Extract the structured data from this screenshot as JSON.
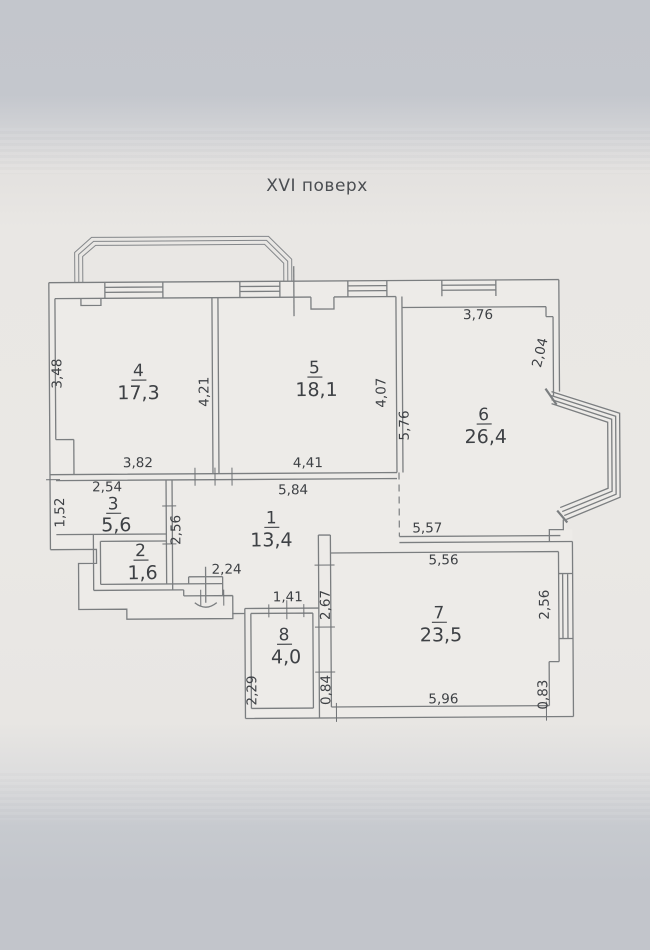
{
  "title": "XVI поверх",
  "rooms": [
    {
      "number": "1",
      "area": "13,4"
    },
    {
      "number": "2",
      "area": "1,6"
    },
    {
      "number": "3",
      "area": "5,6"
    },
    {
      "number": "4",
      "area": "17,3"
    },
    {
      "number": "5",
      "area": "18,1"
    },
    {
      "number": "6",
      "area": "26,4"
    },
    {
      "number": "7",
      "area": "23,5"
    },
    {
      "number": "8",
      "area": "4,0"
    }
  ],
  "dimensions": {
    "room4_left": "3,48",
    "room4_right": "4,21",
    "room4_bottom": "3,82",
    "room5_right": "4,07",
    "room5_bottom": "4,41",
    "room6_top": "3,76",
    "room6_right": "2,04",
    "room6_left": "5,76",
    "room6_bottom": "5,57",
    "room3_top": "2,54",
    "room3_left": "1,52",
    "room3_right": "2,56",
    "room1_top": "5,84",
    "room1_bottom": "2,24",
    "room7_top": "5,56",
    "room7_left": "2,67",
    "room7_right": "2,56",
    "room7_bottom": "5,96",
    "room7_bottom_left": "0,84",
    "room7_bottom_right": "0,83",
    "room8_top": "1,41",
    "room8_left": "2,29"
  },
  "colors": {
    "paper_top": "#c3c6cc",
    "paper_mid": "#eae8e5",
    "paper_bottom": "#c2c5cb",
    "plan_fill": "#edebe8",
    "wall_line": "#7b7e80",
    "text": "#3e4145"
  }
}
